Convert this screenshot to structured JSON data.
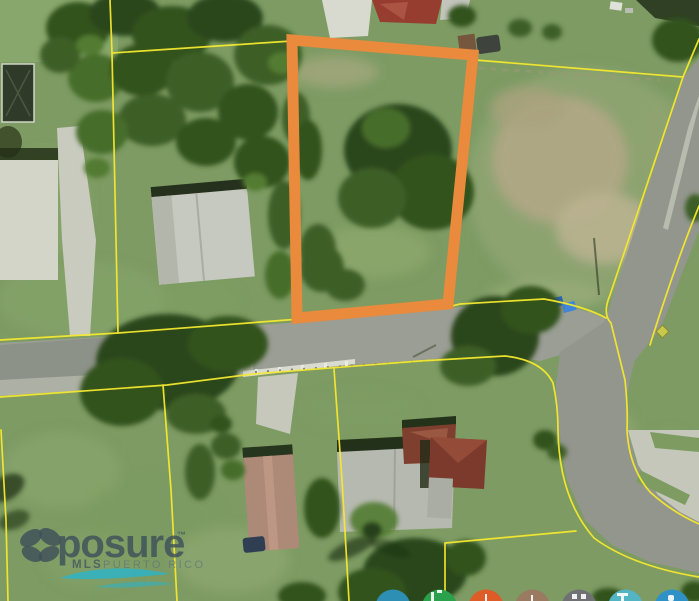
{
  "watermark": {
    "brand_full": "xposure",
    "brand_icon": "butterfly-x-icon",
    "brand_text": "posure",
    "trademark": "™",
    "subtitle_mls": "MLS",
    "subtitle_region": "PUERTO RICO",
    "brand_color": "#3E4F59",
    "swoosh_color": "#2FB3C5"
  },
  "map_overlay": {
    "highlighted_parcel_color": "#E98A3C",
    "parcel_boundary_color": "#F6E82E"
  },
  "share_buttons": [
    {
      "name": "share-button-steel-blue",
      "color": "#2E8FB4"
    },
    {
      "name": "share-button-green",
      "color": "#2BA14C"
    },
    {
      "name": "share-button-orange",
      "color": "#DD5C28"
    },
    {
      "name": "share-button-brown",
      "color": "#9A7A60"
    },
    {
      "name": "share-button-gray",
      "color": "#6F7173"
    },
    {
      "name": "share-button-teal",
      "color": "#53B4C4"
    },
    {
      "name": "share-button-blue",
      "color": "#2F92C6"
    }
  ]
}
